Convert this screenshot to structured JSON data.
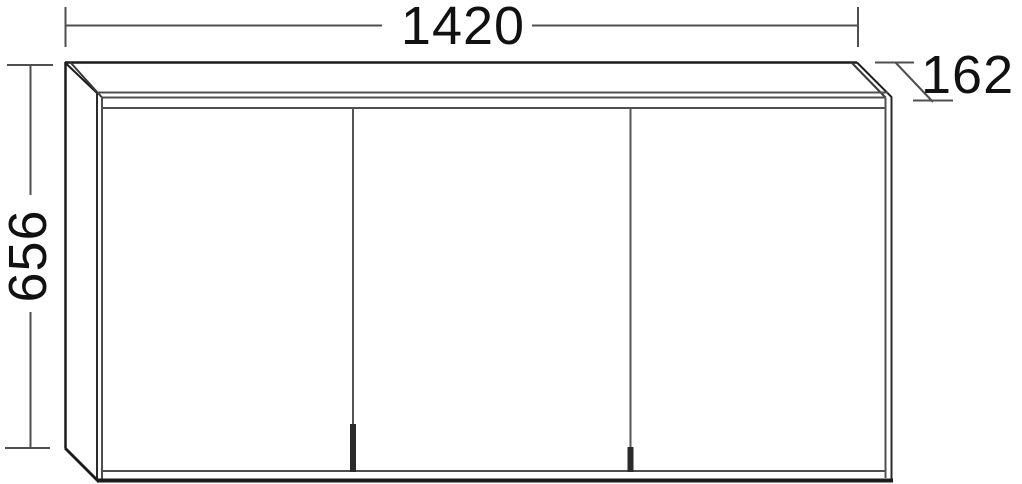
{
  "page": {
    "background": "#ffffff"
  },
  "drawing": {
    "kind": "furniture-technical-drawing",
    "subject": "wall-mounted mirror cabinet with three doors",
    "door_count": 3,
    "colors": {
      "outline": "#1c1c1c",
      "detail_line": "#4f4f4f",
      "dimension_line": "#4f4f4f",
      "handle": "#2b2b2b",
      "text": "#111111"
    },
    "dimension_labels": {
      "width": "1420",
      "height": "656",
      "depth": "162"
    }
  }
}
